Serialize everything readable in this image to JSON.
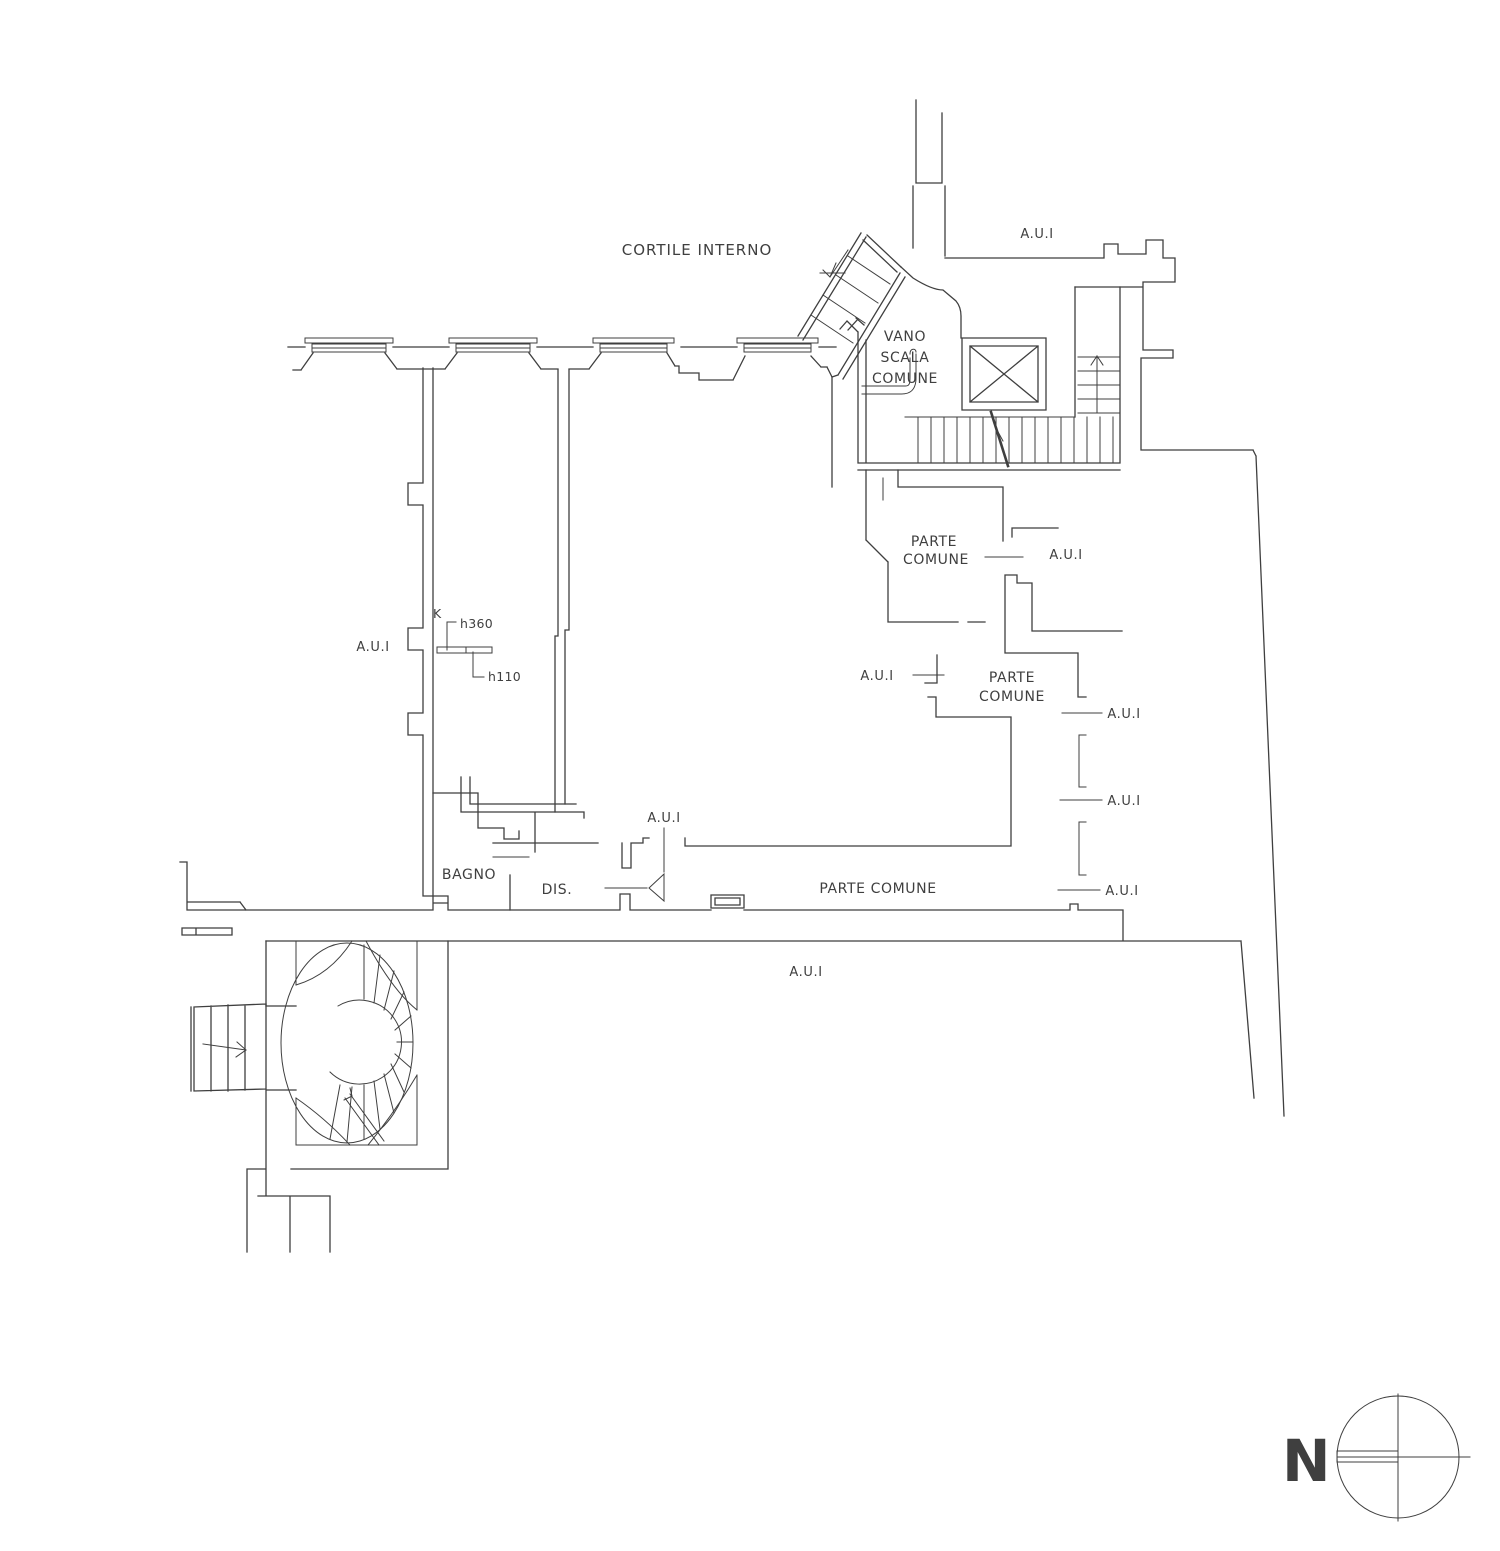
{
  "colors": {
    "line": "#3f3f3f",
    "background": "#ffffff"
  },
  "labels": {
    "courtyard": "CORTILE INTERNO",
    "unit": "A.U.I",
    "stairwell_line1": "VANO",
    "stairwell_line2": "SCALA",
    "stairwell_line3": "COMUNE",
    "common_line1": "PARTE",
    "common_line2": "COMUNE",
    "common_single": "PARTE COMUNE",
    "bathroom": "BAGNO",
    "hallway": "DIS.",
    "kitchen_marker": "K",
    "height_high": "h360",
    "height_low": "h110",
    "north": "N"
  }
}
